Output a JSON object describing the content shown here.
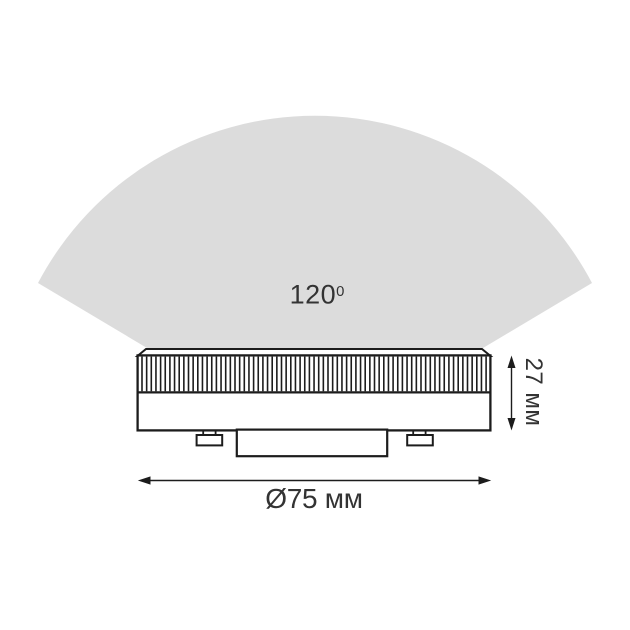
{
  "colors": {
    "background": "#ffffff",
    "beam_fan": "#dcdcdc",
    "outline": "#1c1c1c",
    "text": "#333333"
  },
  "diagram": {
    "beam_angle": {
      "base": "120",
      "sup": "0",
      "label": "120⁰"
    },
    "height_dimension": {
      "label": "27 мм",
      "value_mm": 27
    },
    "diameter_dimension": {
      "label": "Ø75 мм",
      "value_mm": 75
    }
  }
}
